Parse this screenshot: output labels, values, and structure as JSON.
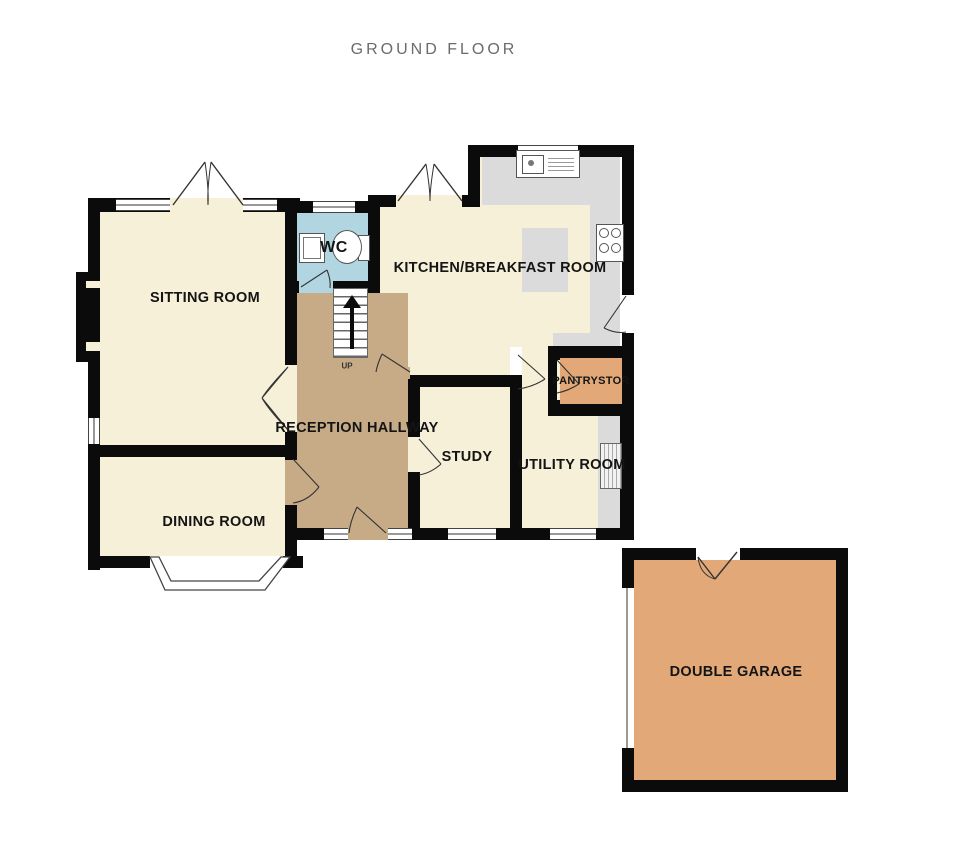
{
  "title": "GROUND FLOOR",
  "floorplan": {
    "rooms": [
      {
        "id": "sitting-room",
        "label": "SITTING ROOM"
      },
      {
        "id": "wc",
        "label": "WC"
      },
      {
        "id": "kitchen-breakfast-room",
        "label": "KITCHEN/BREAKFAST ROOM"
      },
      {
        "id": "reception-hallway",
        "label": "RECEPTION HALLWAY"
      },
      {
        "id": "study",
        "label": "STUDY"
      },
      {
        "id": "pantry-store",
        "label": "PANTRYSTOR"
      },
      {
        "id": "utility-room",
        "label": "UTILITY ROOM"
      },
      {
        "id": "dining-room",
        "label": "DINING ROOM"
      },
      {
        "id": "double-garage",
        "label": "DOUBLE GARAGE"
      }
    ],
    "stairs_label": "UP",
    "fixtures": [
      "kitchen-sink",
      "hob",
      "kitchen-island",
      "wc-basin",
      "toilet",
      "utility-appliance",
      "chimney-breast",
      "bay-window",
      "staircase"
    ],
    "colors": {
      "room_cream": "#F7F0D8",
      "hallway_tan": "#C7AB87",
      "wc_blue": "#B2D6E1",
      "pantry_garage_orange": "#E2A877",
      "counter_gray": "#DBDBDB",
      "wall_black": "#0B0B0B",
      "title_gray": "#6B6B6B"
    }
  }
}
